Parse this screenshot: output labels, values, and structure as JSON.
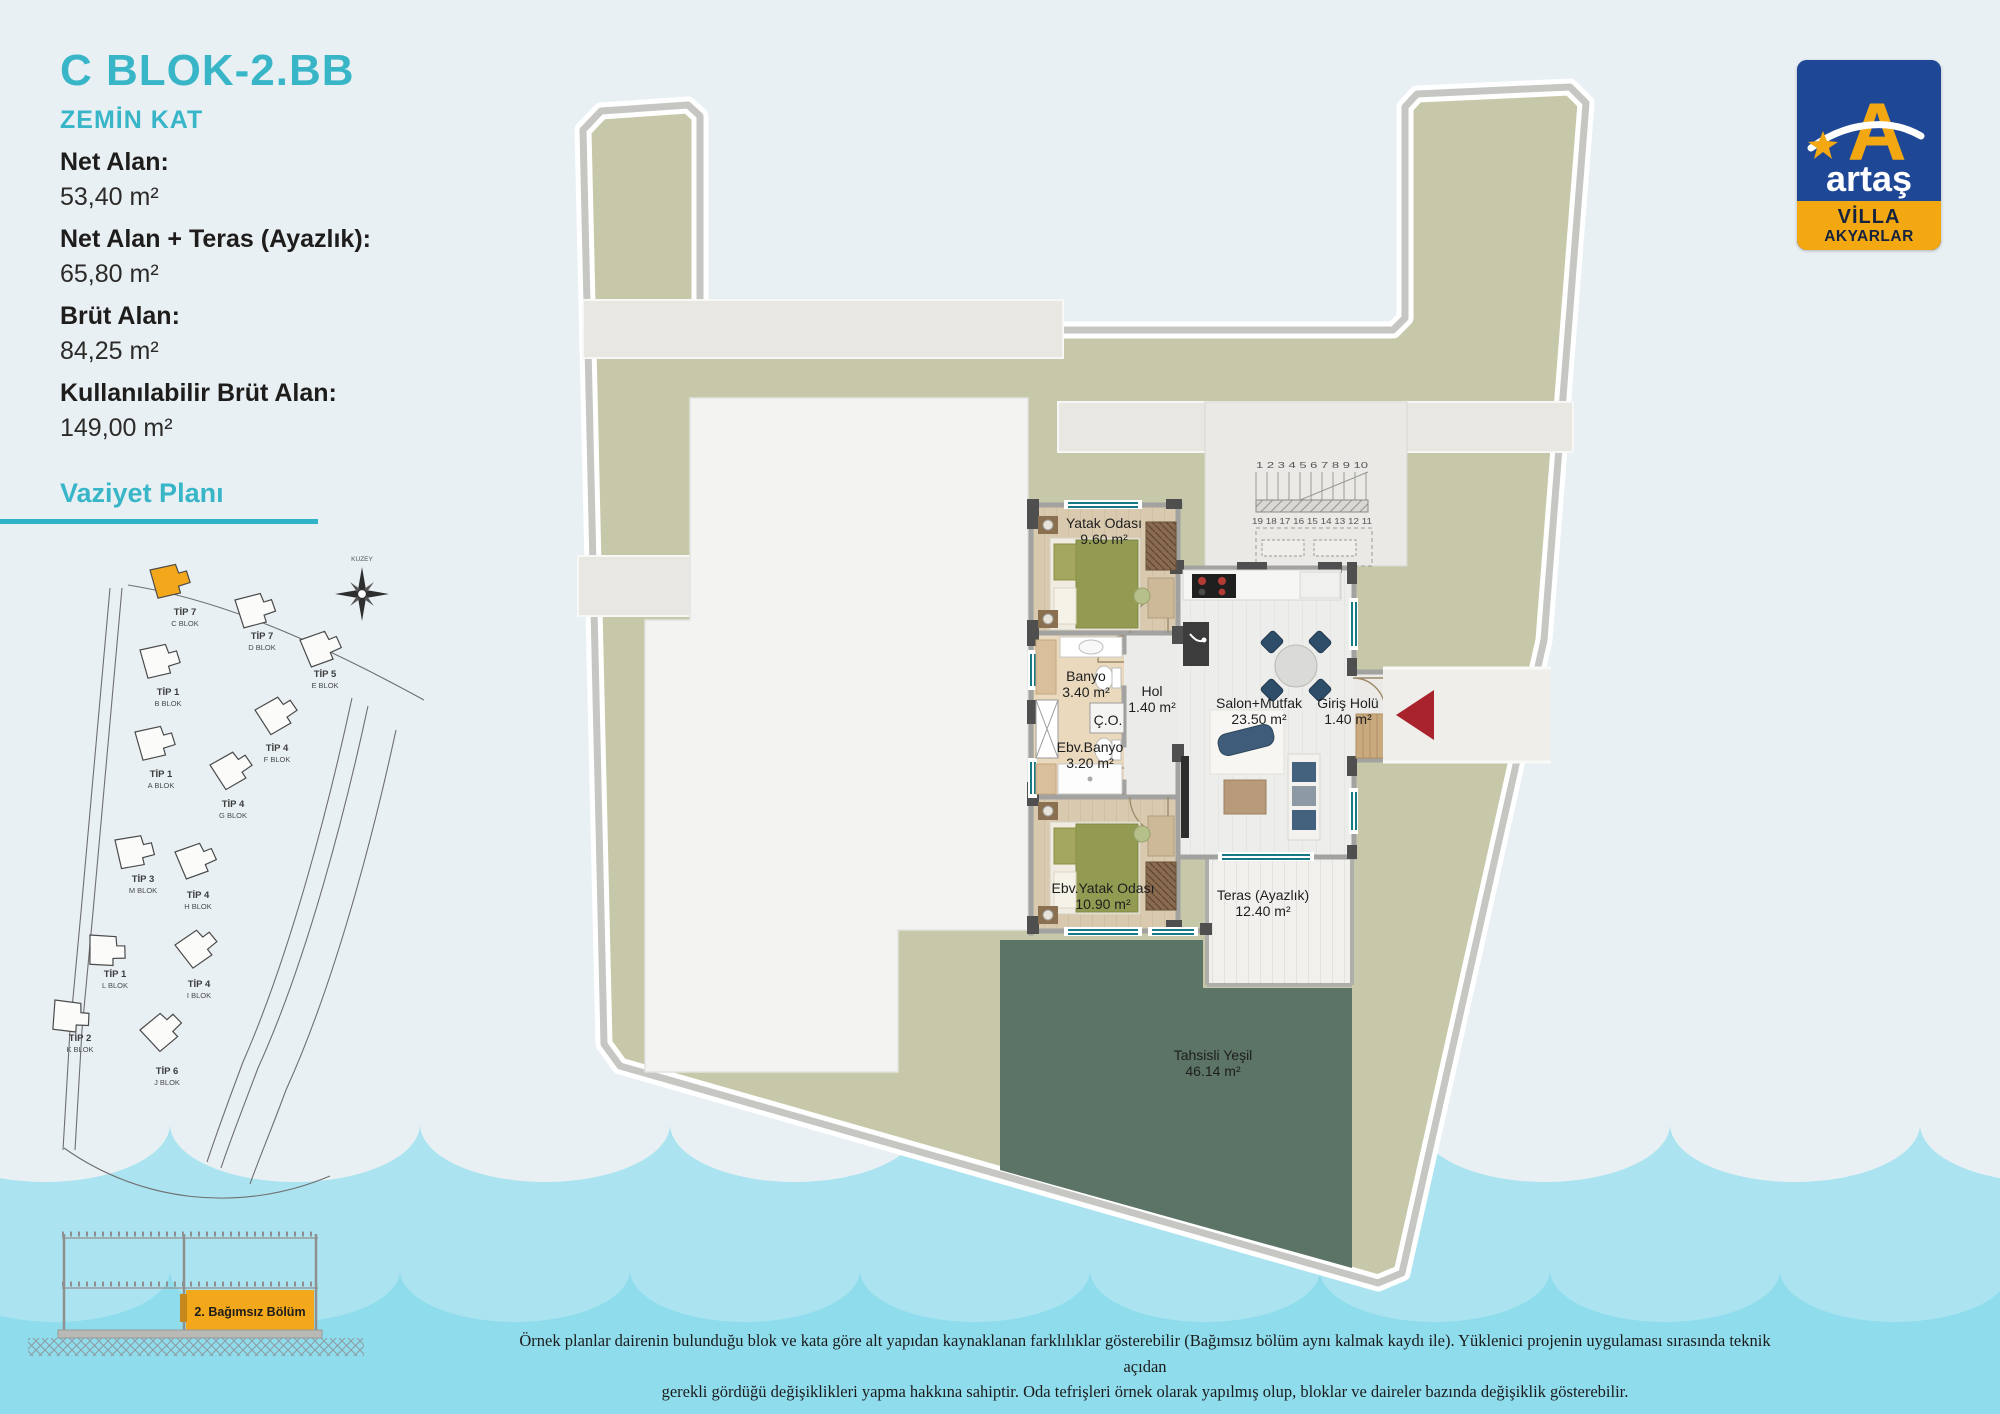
{
  "colors": {
    "accent_teal": "#38b6c8",
    "highlight_orange": "#f3a81c",
    "logo_blue": "#1e4796",
    "plot_khaki": "#c7c8aa",
    "allocated_green": "#5b7466",
    "wave_light": "#abe4f0",
    "wave_dark": "#8fdcec",
    "entry_arrow_red": "#a8232b"
  },
  "info": {
    "title": "C BLOK-2.BB",
    "subtitle": "ZEMİN KAT",
    "fields": [
      {
        "label": "Net Alan:",
        "value": "53,40 m²"
      },
      {
        "label": "Net Alan + Teras (Ayazlık):",
        "value": "65,80 m²"
      },
      {
        "label": "Brüt Alan:",
        "value": "84,25 m²"
      },
      {
        "label": "Kullanılabilir Brüt Alan:",
        "value": "149,00 m²"
      }
    ]
  },
  "site_plan": {
    "heading": "Vaziyet Planı",
    "compass_label": "KUZEY",
    "blocks": [
      {
        "tip": "TİP 7",
        "blok": "C BLOK",
        "highlighted": true
      },
      {
        "tip": "TİP 7",
        "blok": "D BLOK",
        "highlighted": false
      },
      {
        "tip": "TİP 5",
        "blok": "E BLOK",
        "highlighted": false
      },
      {
        "tip": "TİP 1",
        "blok": "B BLOK",
        "highlighted": false
      },
      {
        "tip": "TİP 1",
        "blok": "A BLOK",
        "highlighted": false
      },
      {
        "tip": "TİP 4",
        "blok": "F BLOK",
        "highlighted": false
      },
      {
        "tip": "TİP 4",
        "blok": "G BLOK",
        "highlighted": false
      },
      {
        "tip": "TİP 3",
        "blok": "M BLOK",
        "highlighted": false
      },
      {
        "tip": "TİP 4",
        "blok": "H BLOK",
        "highlighted": false
      },
      {
        "tip": "TİP 1",
        "blok": "L BLOK",
        "highlighted": false
      },
      {
        "tip": "TİP 4",
        "blok": "I BLOK",
        "highlighted": false
      },
      {
        "tip": "TİP 2",
        "blok": "K BLOK",
        "highlighted": false
      },
      {
        "tip": "TİP 6",
        "blok": "J BLOK",
        "highlighted": false
      }
    ]
  },
  "floor_plan": {
    "rooms": [
      {
        "name": "Yatak Odası",
        "area": "9.60 m²"
      },
      {
        "name": "Banyo",
        "area": "3.40 m²"
      },
      {
        "name": "Hol",
        "area": "1.40 m²"
      },
      {
        "name": "Ç.O.",
        "area": ""
      },
      {
        "name": "Ebv.Banyo",
        "area": "3.20 m²"
      },
      {
        "name": "Salon+Mutfak",
        "area": "23.50 m²"
      },
      {
        "name": "Giriş Holü",
        "area": "1.40 m²"
      },
      {
        "name": "Ebv.Yatak Odası",
        "area": "10.90 m²"
      },
      {
        "name": "Teras (Ayazlık)",
        "area": "12.40 m²"
      },
      {
        "name": "Tahsisli Yeşil",
        "area": "46.14 m²"
      }
    ],
    "stair_numbers_top": "1 2 3 4 5 6 7 8 9 10",
    "stair_numbers_bottom": "19 18 17 16 15 14 13 12 11"
  },
  "section_diagram": {
    "label": "2. Bağımsız Bölüm"
  },
  "logo": {
    "brand": "artaş",
    "line1": "VİLLA",
    "line2": "AKYARLAR"
  },
  "disclaimer": {
    "line1": "Örnek planlar dairenin bulunduğu blok ve kata göre alt yapıdan kaynaklanan farklılıklar gösterebilir (Bağımsız bölüm aynı kalmak kaydı ile). Yüklenici projenin uygulaması sırasında teknik açıdan",
    "line2": "gerekli gördüğü değişiklikleri yapma hakkına sahiptir. Oda tefrişleri örnek olarak yapılmış olup, bloklar ve daireler bazında değişiklik gösterebilir."
  }
}
